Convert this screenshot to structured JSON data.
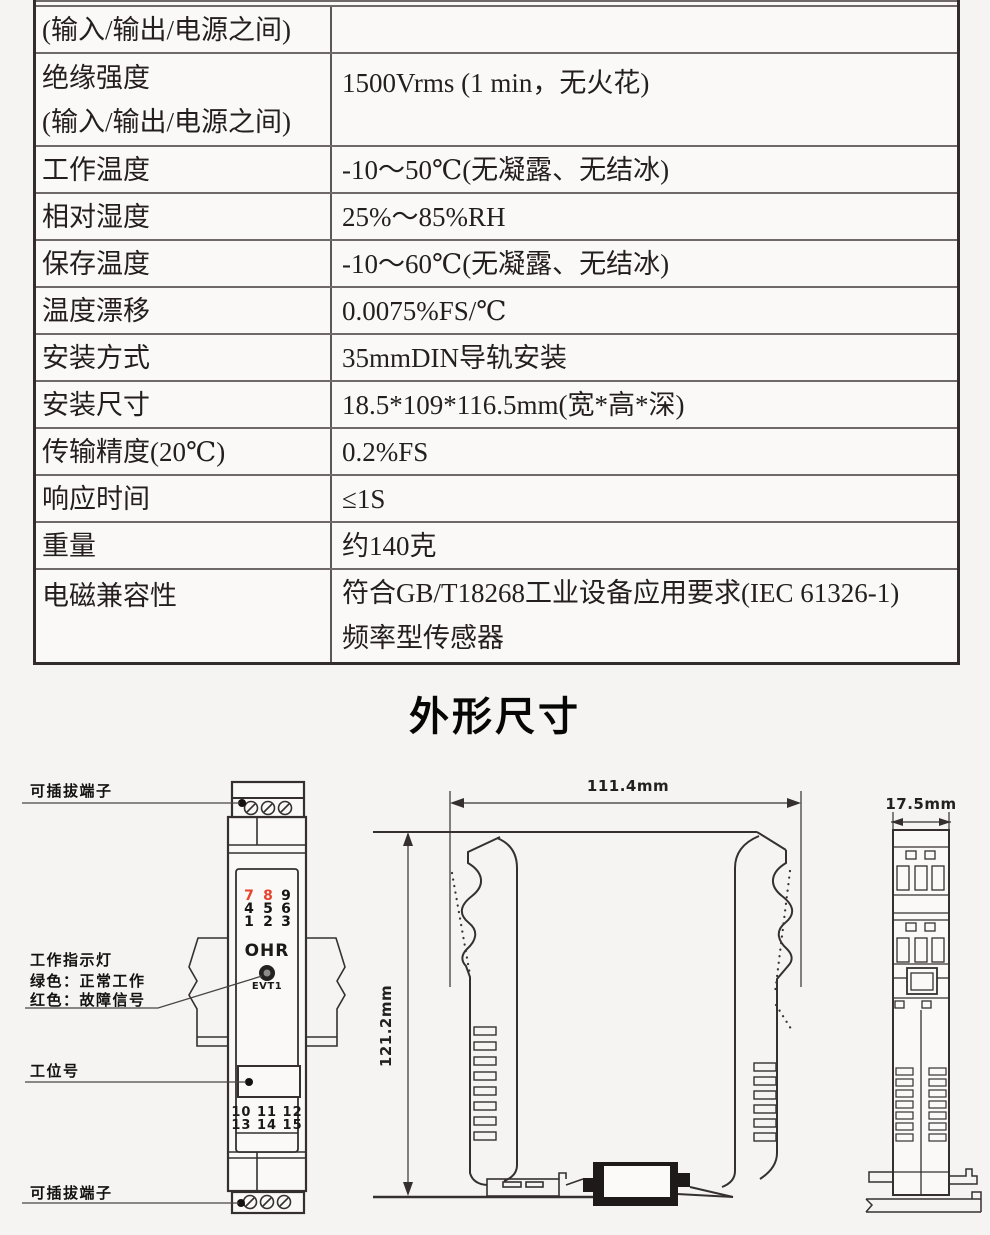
{
  "spec_table": {
    "rows": [
      {
        "label": "(输入/输出/电源之间)",
        "value": ""
      },
      {
        "label": "绝缘强度",
        "label2": "(输入/输出/电源之间)",
        "value": "1500Vrms (1 min，无火花)"
      },
      {
        "label": "工作温度",
        "value": "-10～50℃(无凝露、无结冰)"
      },
      {
        "label": "相对湿度",
        "value": "25%～85%RH"
      },
      {
        "label": "保存温度",
        "value": "-10～60℃(无凝露、无结冰)"
      },
      {
        "label": "温度漂移",
        "value": "0.0075%FS/℃"
      },
      {
        "label": "安装方式",
        "value": "35mmDIN导轨安装"
      },
      {
        "label": "安装尺寸",
        "value": "18.5*109*116.5mm(宽*高*深)"
      },
      {
        "label": "传输精度(20℃)",
        "value": "0.2%FS"
      },
      {
        "label": "响应时间",
        "value": "≤1S"
      },
      {
        "label": "重量",
        "value": "约140克"
      },
      {
        "label": "电磁兼容性",
        "value": "符合GB/T18268工业设备应用要求(IEC 61326-1)",
        "value2": "频率型传感器"
      }
    ]
  },
  "outline": {
    "heading": "外形尺寸",
    "callouts": {
      "terminal_top": "可插拔端子",
      "indicator_title": "工作指示灯",
      "indicator_green": "绿色：正常工作",
      "indicator_red": "红色：故障信号",
      "station_label": "工位号",
      "terminal_bottom": "可插拔端子"
    },
    "front_view": {
      "digits": [
        "7",
        "8",
        "9",
        "4",
        "5",
        "6",
        "1",
        "2",
        "3"
      ],
      "brand": "OHR",
      "led_label": "EVT1",
      "terminal_row1": "10 11 12",
      "terminal_row2": "13 14 15"
    },
    "dimensions": {
      "width_top": "111.4mm",
      "height_side": "121.2mm",
      "width_end": "17.5mm"
    },
    "colors": {
      "digit_red": "#e8432c",
      "line": "#35302f"
    }
  }
}
